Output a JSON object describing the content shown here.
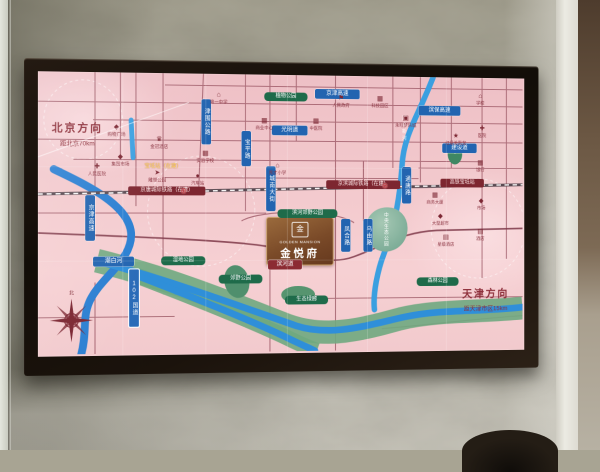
{
  "map": {
    "plaque": {
      "seal": "金",
      "en": "GOLDEN MANSION",
      "cn": "金悦府"
    },
    "directions": {
      "beijing": {
        "title": "北京方向",
        "subtitle": "距北京70km"
      },
      "tianjin": {
        "title": "天津方向",
        "subtitle": "距天津市区15km"
      }
    },
    "compass_north": "北",
    "lake_label": "中央生态公园",
    "river_vertical_label": "潮白新河",
    "station_note": {
      "t": "宝坻站（在建）",
      "x": 128,
      "y": 92
    },
    "icon_glyphs": {
      "crown": "♛",
      "star": "★",
      "hospital": "✚",
      "school": "⌂",
      "building": "▦",
      "mall": "▣",
      "cart": "◆",
      "hotel": "▤",
      "car": "●",
      "bird": "➤",
      "flag": "⚑"
    },
    "ribbons_h": [
      {
        "t": "京津高速",
        "x": 288,
        "y": 14,
        "w": 44
      },
      {
        "t": "滨保高速",
        "x": 400,
        "y": 30,
        "w": 42
      },
      {
        "t": "光明道",
        "x": 242,
        "y": 52,
        "w": 34
      },
      {
        "t": "建设道",
        "x": 426,
        "y": 69,
        "w": 34
      },
      {
        "t": "潮白河",
        "x": 56,
        "y": 186,
        "w": 38
      },
      {
        "t": "滨河道",
        "x": 238,
        "y": 190,
        "w": 32,
        "s": "road"
      }
    ],
    "ribbons_v": [
      {
        "t": "津围公路",
        "x": 168,
        "y": 26,
        "h": 42
      },
      {
        "t": "宝平路",
        "x": 210,
        "y": 58,
        "h": 32
      },
      {
        "t": "城南大街",
        "x": 236,
        "y": 94,
        "h": 42
      },
      {
        "t": "京津高速",
        "x": 48,
        "y": 124,
        "h": 42
      },
      {
        "t": "通唐路",
        "x": 382,
        "y": 94,
        "h": 34
      },
      {
        "t": "凤合路",
        "x": 316,
        "y": 148,
        "h": 30
      },
      {
        "t": "乌由路",
        "x": 340,
        "y": 148,
        "h": 30
      },
      {
        "t": "102国道",
        "x": 92,
        "y": 198,
        "h": 54,
        "s": "gd"
      }
    ],
    "rails": [
      {
        "t": "京唐城际铁路（在建）",
        "x": 92,
        "y": 115,
        "w": 76
      },
      {
        "t": "京滨城际铁路（在建）",
        "x": 300,
        "y": 108,
        "w": 76
      },
      {
        "t": "高铁宝坻站",
        "x": 424,
        "y": 106,
        "w": 44
      }
    ],
    "stations": [
      {
        "x": 146,
        "y": 116
      },
      {
        "x": 360,
        "y": 110
      }
    ],
    "parks": [
      {
        "t": "滨河郊野公园",
        "x": 248,
        "y": 138,
        "w": 58
      },
      {
        "t": "植物公园",
        "x": 234,
        "y": 18,
        "w": 40
      },
      {
        "t": "湿地公园",
        "x": 126,
        "y": 186,
        "w": 40
      },
      {
        "t": "郊野公园",
        "x": 186,
        "y": 205,
        "w": 40
      },
      {
        "t": "森林公园",
        "x": 398,
        "y": 209,
        "w": 40
      },
      {
        "t": "生态绿廊",
        "x": 256,
        "y": 227,
        "w": 40
      }
    ],
    "landmarks": [
      {
        "icon": "cart",
        "t": "购物广场",
        "x": 80,
        "y": 52
      },
      {
        "icon": "crown",
        "t": "金冠酒店",
        "x": 124,
        "y": 64
      },
      {
        "icon": "hospital",
        "t": "人民医院",
        "x": 60,
        "y": 92
      },
      {
        "icon": "cart",
        "t": "集贸市场",
        "x": 84,
        "y": 82
      },
      {
        "icon": "bird",
        "t": "雕塑公园",
        "x": 122,
        "y": 98
      },
      {
        "icon": "school",
        "t": "第一中学",
        "x": 186,
        "y": 18
      },
      {
        "icon": "building",
        "t": "实验学校",
        "x": 172,
        "y": 78
      },
      {
        "icon": "car",
        "t": "汽车站",
        "x": 164,
        "y": 101
      },
      {
        "icon": "building",
        "t": "商业中心",
        "x": 234,
        "y": 44
      },
      {
        "icon": "flag",
        "t": "人民政府",
        "x": 316,
        "y": 20
      },
      {
        "icon": "building",
        "t": "中医院",
        "x": 289,
        "y": 44
      },
      {
        "icon": "school",
        "t": "育才小学",
        "x": 248,
        "y": 90
      },
      {
        "icon": "building",
        "t": "科技园区",
        "x": 358,
        "y": 20
      },
      {
        "icon": "mall",
        "t": "永旺梦乐城",
        "x": 386,
        "y": 40
      },
      {
        "icon": "star",
        "t": "红星美凯龙",
        "x": 441,
        "y": 58
      },
      {
        "icon": "building",
        "t": "商务大厦",
        "x": 418,
        "y": 120
      },
      {
        "icon": "cart",
        "t": "大型超市",
        "x": 424,
        "y": 142
      },
      {
        "icon": "hotel",
        "t": "星级酒店",
        "x": 430,
        "y": 164
      },
      {
        "icon": "school",
        "t": "学校",
        "x": 468,
        "y": 16
      },
      {
        "icon": "hospital",
        "t": "医院",
        "x": 470,
        "y": 50
      },
      {
        "icon": "building",
        "t": "银行",
        "x": 468,
        "y": 86
      },
      {
        "icon": "cart",
        "t": "市场",
        "x": 469,
        "y": 126
      },
      {
        "icon": "hotel",
        "t": "酒店",
        "x": 468,
        "y": 158
      }
    ],
    "colors": {
      "map_pink": "#f2c8cc",
      "river_blue": "#2f8fd9",
      "park_green": "#1e6b4a",
      "road_maroon": "#8c4250",
      "plaque_bronze": "#7a4a28",
      "ribbon_blue": "#2264b0"
    }
  }
}
